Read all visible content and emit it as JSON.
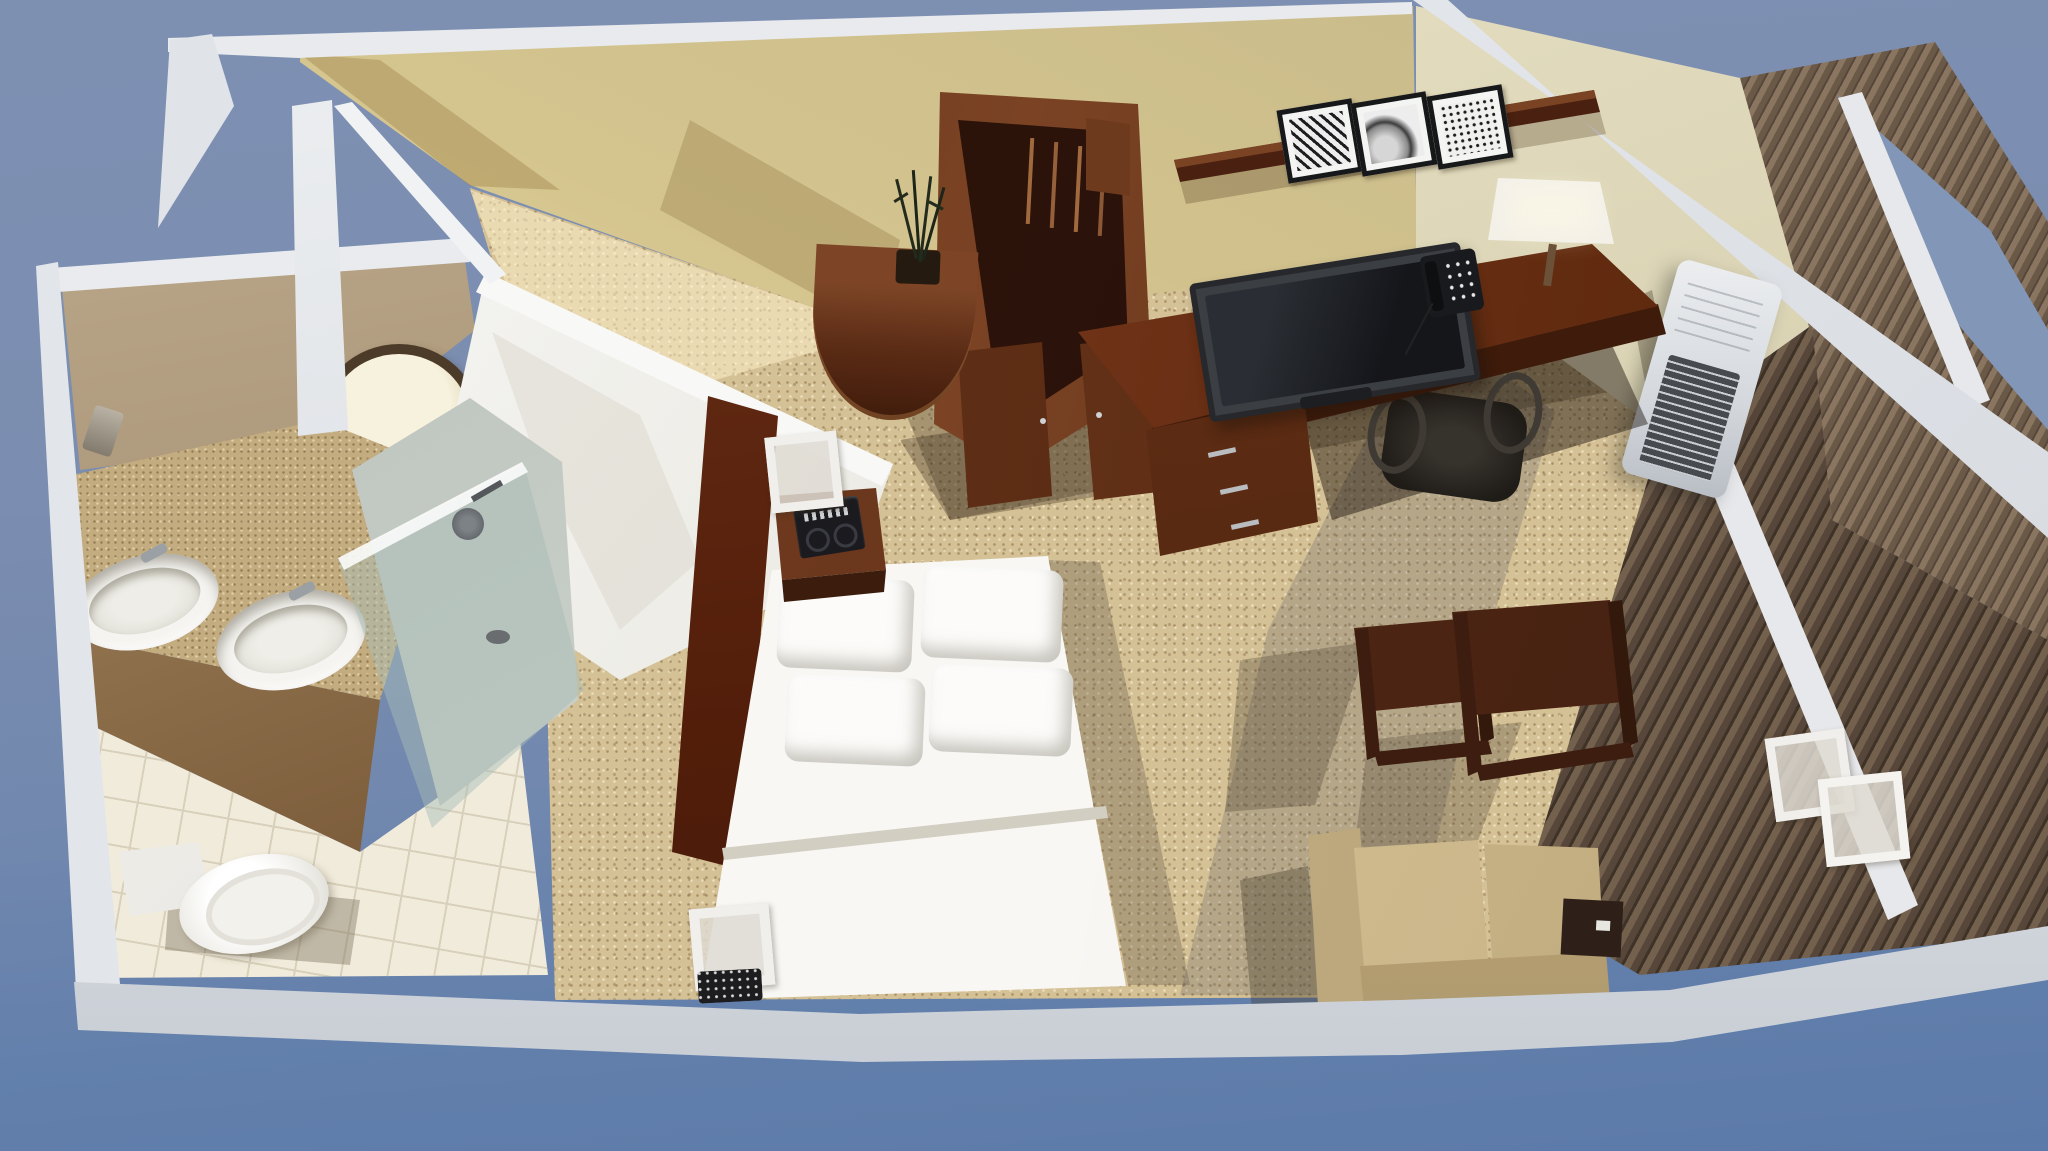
{
  "scene": {
    "type": "3d-room-rendering",
    "description": "Bird's-eye cutaway 3D rendering of a hotel studio suite floor plan on a blue background",
    "view": "top-down isometric cutaway, walls sliced open",
    "rooms": [
      "bathroom",
      "entry",
      "sleeping-area",
      "work-area",
      "sitting-area"
    ]
  },
  "palette": {
    "background_blue_top": "#7e90b2",
    "background_blue_bottom": "#5c7aa9",
    "outer_wall_white": "#e8eaed",
    "accent_wall_yellow": "#d8c88e",
    "side_wall_cream": "#e0d9bd",
    "carpet_tan": "#d5c196",
    "bathroom_tile": "#f1ebdc",
    "granite_counter": "#c3ac80",
    "dark_wood": "#5a2b15",
    "bedding_white": "#f7f6f3",
    "sofa_beige": "#cdb88b",
    "glass_blue": "#8296b7"
  },
  "bathroom": {
    "fixtures": [
      "double-sink vanity",
      "magnifying mirror",
      "wall sconce",
      "toilet",
      "glass walk-in shower",
      "shower head",
      "floor drain",
      "tile floor"
    ]
  },
  "entry": {
    "fixtures": [
      "entry door ajar",
      "door handle",
      "corridor"
    ]
  },
  "sleeping_area": {
    "fixtures": [
      "queen bed with white bedding",
      "four pillows",
      "dark wood headboard",
      "head nightstand",
      "clock radio",
      "tissue-box cube",
      "foot bench nightstand",
      "cube lamp",
      "telephone"
    ]
  },
  "work_area": {
    "fixtures": [
      "open wardrobe with hangers",
      "console table with plant",
      "writing desk",
      "flat-screen tv",
      "desk phone",
      "desk lamp",
      "drawer unit",
      "office chair",
      "wall shelf",
      "three framed prints"
    ]
  },
  "sitting_area": {
    "fixtures": [
      "loveseat sofa",
      "sofa side table",
      "two cube nesting tables",
      "wall air-conditioner unit",
      "window wall with blinds",
      "two cube lanterns"
    ]
  }
}
